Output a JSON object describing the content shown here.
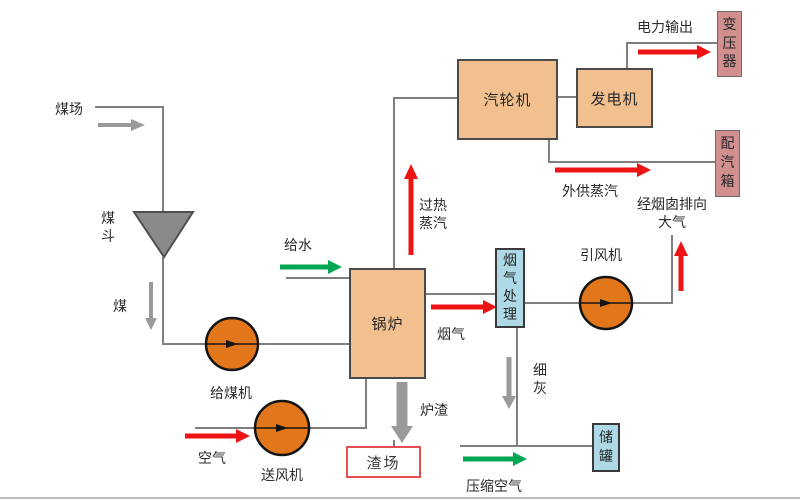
{
  "colors": {
    "box_peach": "#f2c08e",
    "box_pink": "#d18f8f",
    "box_blue": "#aedae8",
    "circle_orange": "#e2761b",
    "funnel_gray": "#8a8a8a",
    "line_gray": "#7f7f7f",
    "arrow_red": "#ee1414",
    "arrow_green": "#00a651",
    "arrow_gray": "#9a9a9a",
    "slag_border_red": "#e4504f"
  },
  "nodes": {
    "coal_hopper": "煤斗",
    "coal_feeder": "给煤机",
    "forced_draft_fan": "送风机",
    "boiler": "锅炉",
    "turbine": "汽轮机",
    "generator": "发电机",
    "transformer": "变压器",
    "steam_distribution_box": "配汽箱",
    "flue_gas_treatment": "烟气处理",
    "induced_draft_fan": "引风机",
    "storage_tank": "储罐",
    "slag_yard": "渣场"
  },
  "flows": {
    "coal_yard": "煤场",
    "coal": "煤",
    "air": "空气",
    "feed_water": "给水",
    "superheated_steam": "过热蒸汽",
    "flue_gas": "烟气",
    "power_output": "电力输出",
    "external_steam_supply": "外供蒸汽",
    "chimney_to_atmosphere": "经烟囱排向大气",
    "fine_ash": "细灰",
    "slag": "炉渣",
    "compressed_air": "压缩空气"
  }
}
